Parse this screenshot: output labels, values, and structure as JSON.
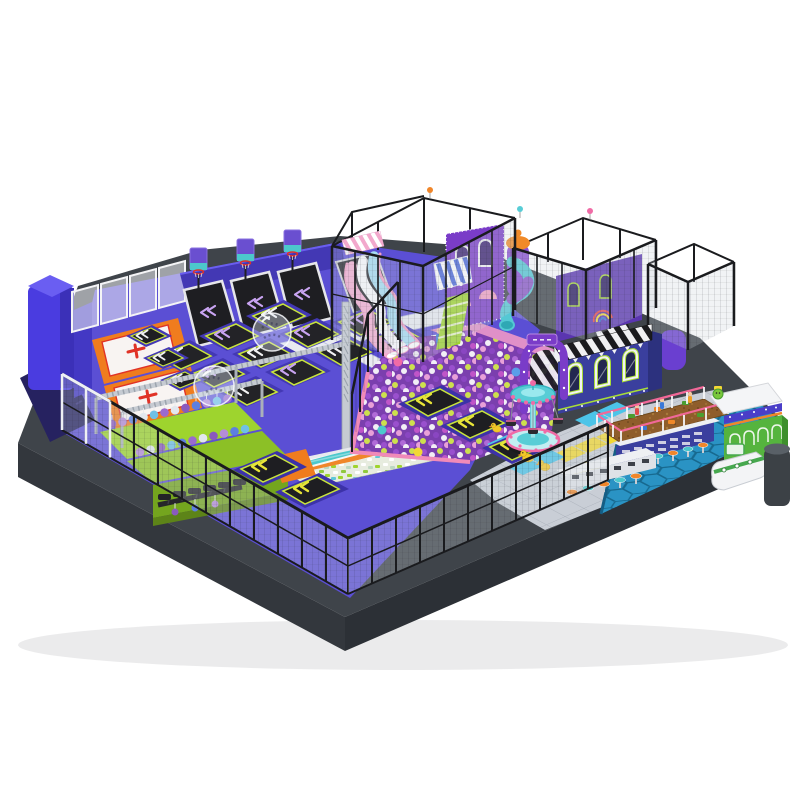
{
  "scene": {
    "type": "3d-product-render",
    "subject": "indoor playground trampoline park on a raised dark platform, isometric view, white background",
    "background": "#ffffff",
    "palette": {
      "platformTop": "#3f444a",
      "platformFaceLeft": "#33373d",
      "platformFaceRight": "#2c3036",
      "purpleFloor": "#5b4fd4",
      "trampFrame": "#4338b4",
      "trampMat": "#232327",
      "limeBorder": "#c8e43c",
      "walkwayWhite": "#e9ebf1",
      "matOrange": "#f07c1e",
      "crossRed": "#e03226",
      "ninjaLime": "#9ed42e",
      "truss": "#c6cbd2",
      "ballBase": "#7b3fae",
      "slidePink": "#f4aed2",
      "slideWhite": "#fbfbfd",
      "slideBlue": "#a6dcf2",
      "castlePurple": "#7a3cc8",
      "rocketPurple": "#8a4fd2",
      "rocketOrange": "#f08a28",
      "tubeTeal": "#55c8d4",
      "tubePurple": "#8a58c8",
      "awningBlue": "#4a66d8",
      "meshBlack": "#1a1b1e",
      "buildingIndigo": "#3a3f9e",
      "limeWindow": "#a8dc38",
      "plazaTile": "#c9ced6",
      "tileYellow": "#f2d834",
      "tileCyan": "#4cc4e8",
      "poolBlue": "#2a93c4",
      "poolHexLine": "#17698f",
      "sandBrown": "#8f5d2b",
      "fencePink": "#f16898",
      "counterWhite": "#eef0f3",
      "stoolOrange": "#f0862a",
      "stoolTeal": "#4cc8cc",
      "boatGreen": "#46a84e",
      "kioskGreen": "#55b43e",
      "duckYellow": "#f2c829",
      "carouselTeal": "#58cdd6",
      "carouselPink": "#f06ba6",
      "towerBlue": "#4a3ce0"
    },
    "zones": [
      {
        "id": "platform-base",
        "label": "dark grey raised platform base"
      },
      {
        "id": "trampoline-court",
        "label": "purple free-jump trampoline court with chevron jump mats",
        "cells": 11
      },
      {
        "id": "dunk-lanes",
        "label": "angled basketball dunk trampolines",
        "hoops": 3
      },
      {
        "id": "airbag-mats",
        "label": "orange framed landing mats with red cross",
        "count": 2
      },
      {
        "id": "ninja-course",
        "label": "lime ninja obstacle course with hanging ball obstacles and silver truss"
      },
      {
        "id": "foam-pit",
        "label": "foam cube pit crossed by an orange and teal striped battle beam"
      },
      {
        "id": "ball-pit",
        "label": "giant ball pit of purple, white and green balls"
      },
      {
        "id": "wave-slide",
        "label": "triple wave slide",
        "lane_colors": [
          "pink",
          "white",
          "blue"
        ]
      },
      {
        "id": "spiral-tube-slide",
        "label": "teal and purple spiral tube slide"
      },
      {
        "id": "soft-play-structure",
        "label": "multi-level soft play structure in black mesh cage with purple castle facade"
      },
      {
        "id": "rocket-tower",
        "label": "purple rocket tower with orange dome"
      },
      {
        "id": "awning",
        "label": "blue and white striped awning"
      },
      {
        "id": "stairs",
        "label": "green access stairs"
      },
      {
        "id": "entrance-arch",
        "label": "purple entrance arch over black and white striped stairway"
      },
      {
        "id": "station-building",
        "label": "indigo facade with black-white striped roof band",
        "arched_windows": 3
      },
      {
        "id": "carousel",
        "label": "teal and pink kiddie carousel",
        "seats": 3
      },
      {
        "id": "plaza",
        "label": "grey tiled plaza with yellow and cyan accent tiles"
      },
      {
        "id": "rubber-ducks",
        "count": 3
      },
      {
        "id": "zorb-bubbles",
        "count": 2
      },
      {
        "id": "sand-pit",
        "label": "brown sand play pit with toy diggers and pink-white fence"
      },
      {
        "id": "ball-pool",
        "label": "blue honeycomb-tiled ball pool"
      },
      {
        "id": "snack-counter",
        "label": "white snack counters with stools",
        "stools": 11
      },
      {
        "id": "boat",
        "label": "white and green play boat"
      },
      {
        "id": "kiosk",
        "label": "green kiosk with white scalloped arches and mascot"
      },
      {
        "id": "safety-fence",
        "label": "black steel safety fence with translucent panels"
      },
      {
        "id": "corner-tower",
        "label": "blue padded corner tower"
      },
      {
        "id": "basketball-backboards",
        "count": 3
      }
    ]
  }
}
